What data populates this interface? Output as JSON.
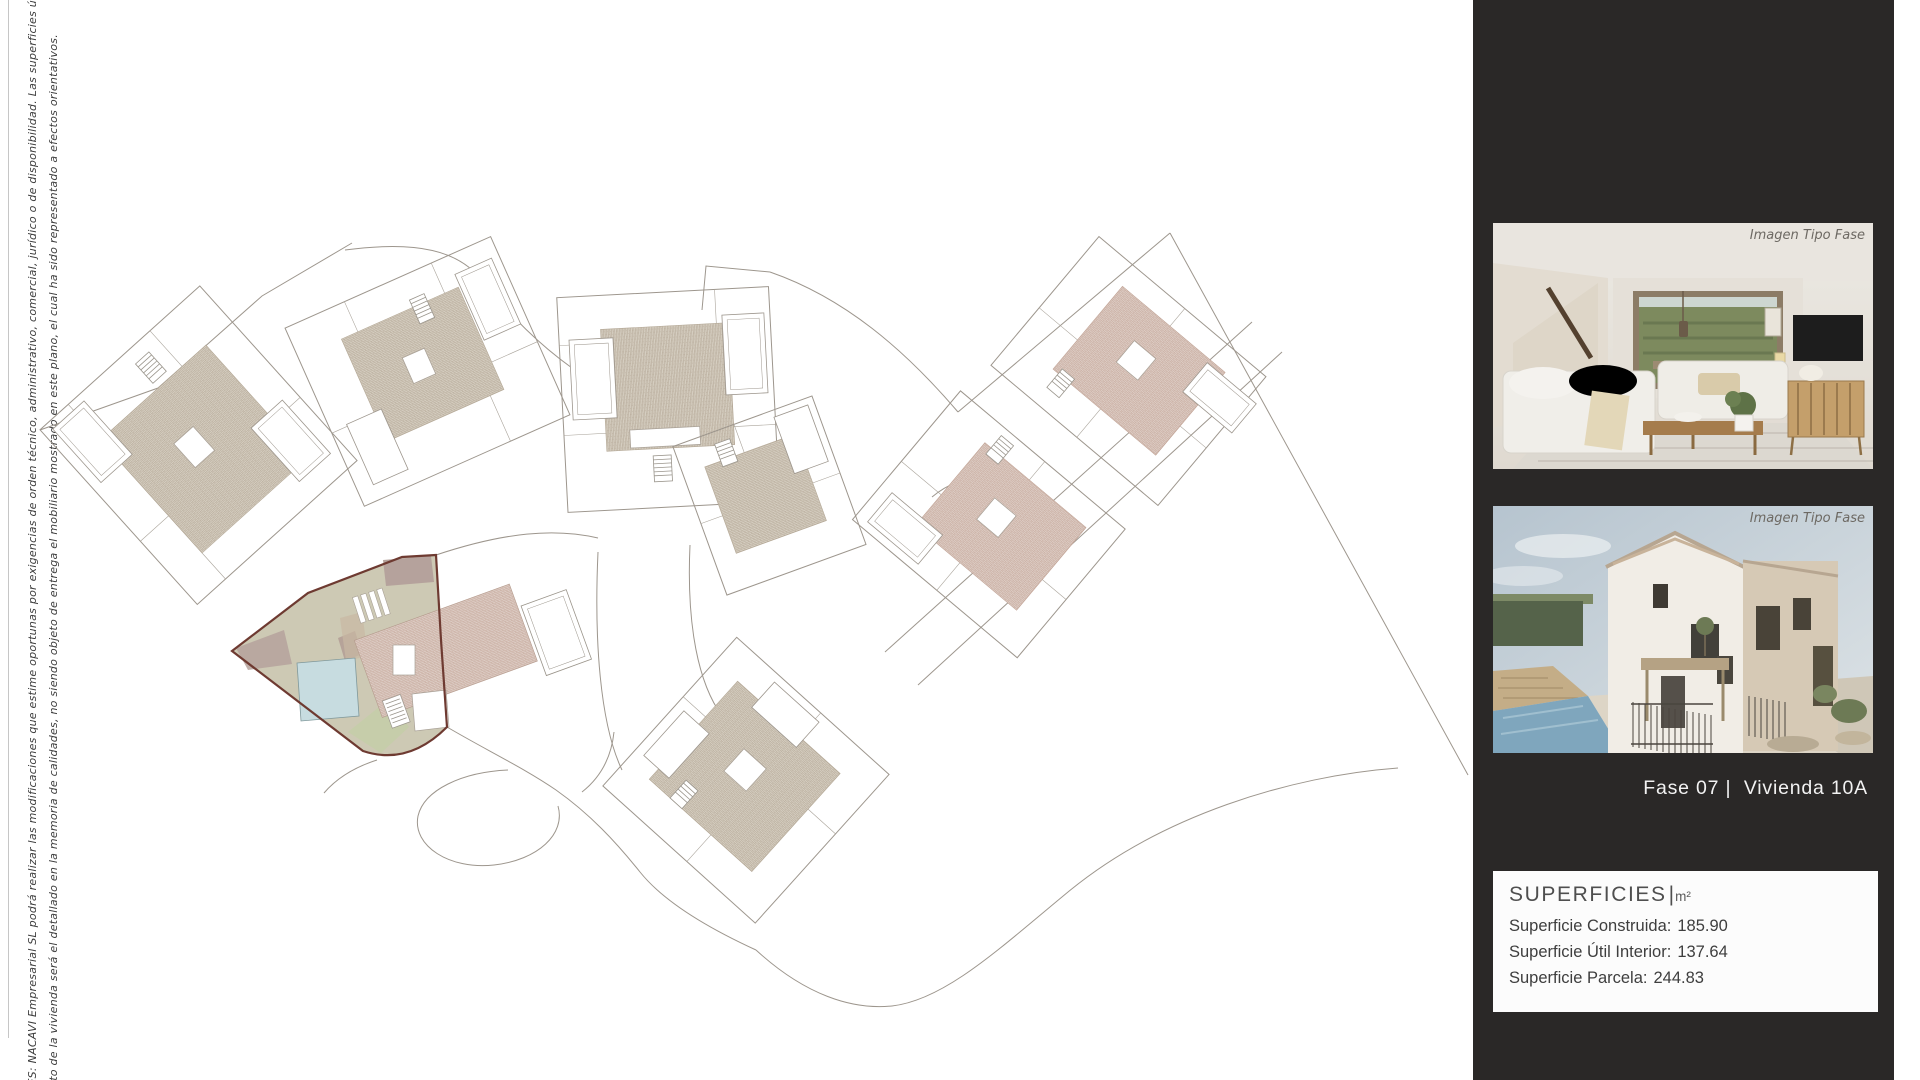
{
  "page": {
    "background": "#ffffff"
  },
  "disclaimer": {
    "line1": "NES: NACAVI Empresarial SL podrá realizar las modificaciones que estime oportunas por exigencias de orden técnico, administrativo, comercial, jurídico o de disponibilidad. Las superficies útiles y constructivas s",
    "line2": "nto de la vivienda será el detallado en la memoria de calidades, no siendo objeto de entrega el mobiliario mostrado en este plano, el cual ha sido representado a efectos orientativos."
  },
  "plan": {
    "colors": {
      "line": "#9d968d",
      "hatch_warm": "#b5a897",
      "hatch_warm_bg": "#d7d0c3",
      "hatch_pink": "#c6a89b",
      "hatch_pink_bg": "#decfc7",
      "highlight_fill": "#cdc9b4",
      "highlight_border": "#6e3a31",
      "pool_blue": "#c7dce0",
      "garden_green": "#c6cdaa",
      "terrace_mauve": "#b5a29c"
    }
  },
  "sidebar": {
    "background": "#2a2827",
    "photos": [
      {
        "caption": "Imagen Tipo Fase"
      },
      {
        "caption": "Imagen Tipo Fase"
      }
    ],
    "unit_label": "Fase 07 |  Vivienda 10A",
    "superficies": {
      "title": "SUPERFICIES",
      "divider": "|",
      "unit": "m²",
      "rows": {
        "construida": {
          "label": "Superficie Construida:",
          "value": "185.90"
        },
        "util": {
          "label": "Superficie Útil Interior:",
          "value": "137.64"
        },
        "parcela": {
          "label": "Superficie Parcela:",
          "value": "244.83"
        }
      }
    }
  }
}
